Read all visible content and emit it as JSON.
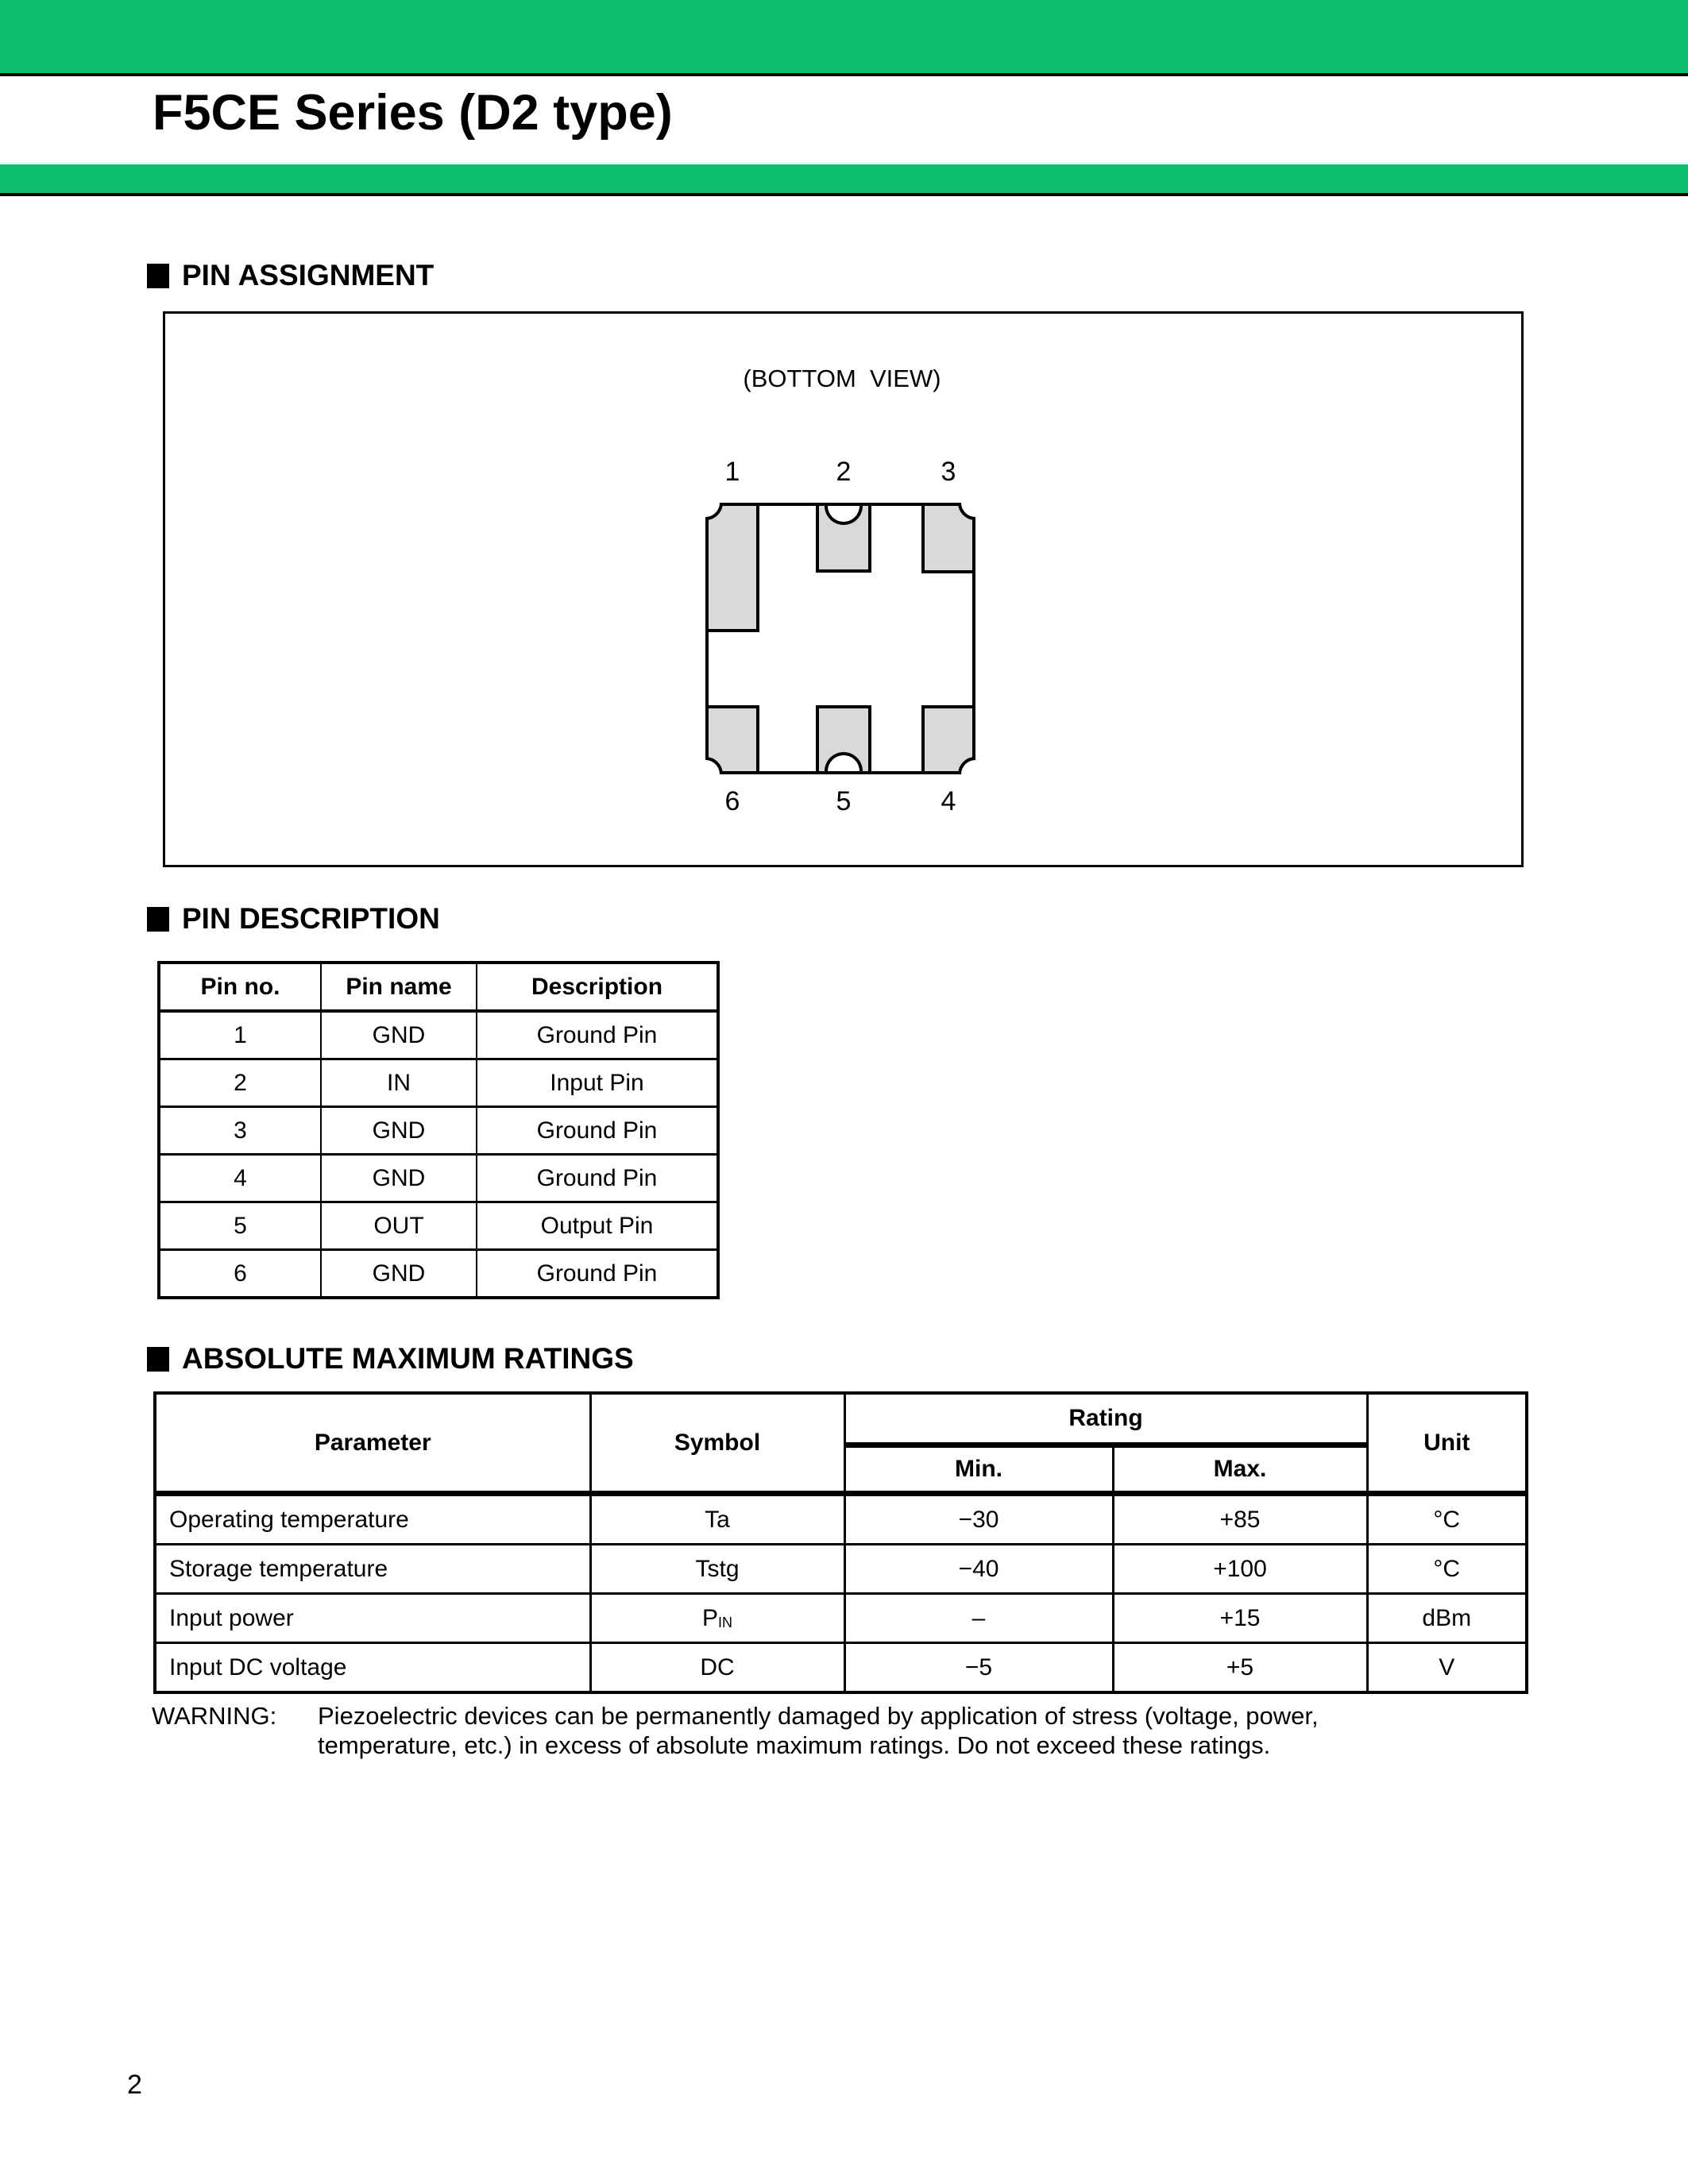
{
  "page": {
    "number": "2",
    "accent_color": "#0cbf6e"
  },
  "title": "F5CE Series (D2 type)",
  "sections": {
    "pin_assignment": {
      "heading": "PIN ASSIGNMENT",
      "view_label": "(BOTTOM  VIEW)",
      "top_pins": [
        "1",
        "2",
        "3"
      ],
      "bottom_pins": [
        "6",
        "5",
        "4"
      ]
    },
    "pin_description": {
      "heading": "PIN DESCRIPTION",
      "columns": [
        "Pin no.",
        "Pin name",
        "Description"
      ],
      "rows": [
        [
          "1",
          "GND",
          "Ground Pin"
        ],
        [
          "2",
          "IN",
          "Input Pin"
        ],
        [
          "3",
          "GND",
          "Ground Pin"
        ],
        [
          "4",
          "GND",
          "Ground Pin"
        ],
        [
          "5",
          "OUT",
          "Output Pin"
        ],
        [
          "6",
          "GND",
          "Ground Pin"
        ]
      ]
    },
    "absolute_maximum_ratings": {
      "heading": "ABSOLUTE MAXIMUM RATINGS",
      "columns": {
        "parameter": "Parameter",
        "symbol": "Symbol",
        "rating": "Rating",
        "min": "Min.",
        "max": "Max.",
        "unit": "Unit"
      },
      "rows": [
        {
          "parameter": "Operating temperature",
          "symbol": "Ta",
          "symbol_sub": "",
          "min": "−30",
          "max": "+85",
          "unit": "°C"
        },
        {
          "parameter": "Storage temperature",
          "symbol": "Tstg",
          "symbol_sub": "",
          "min": "−40",
          "max": "+100",
          "unit": "°C"
        },
        {
          "parameter": "Input power",
          "symbol": "P",
          "symbol_sub": "IN",
          "min": "–",
          "max": "+15",
          "unit": "dBm"
        },
        {
          "parameter": "Input DC voltage",
          "symbol": "DC",
          "symbol_sub": "",
          "min": "−5",
          "max": "+5",
          "unit": "V"
        }
      ]
    }
  },
  "warning": {
    "label": "WARNING:",
    "line1": "Piezoelectric devices can be permanently damaged by application of stress (voltage, power,",
    "line2": "temperature, etc.) in excess of absolute maximum ratings.  Do not exceed these ratings."
  }
}
